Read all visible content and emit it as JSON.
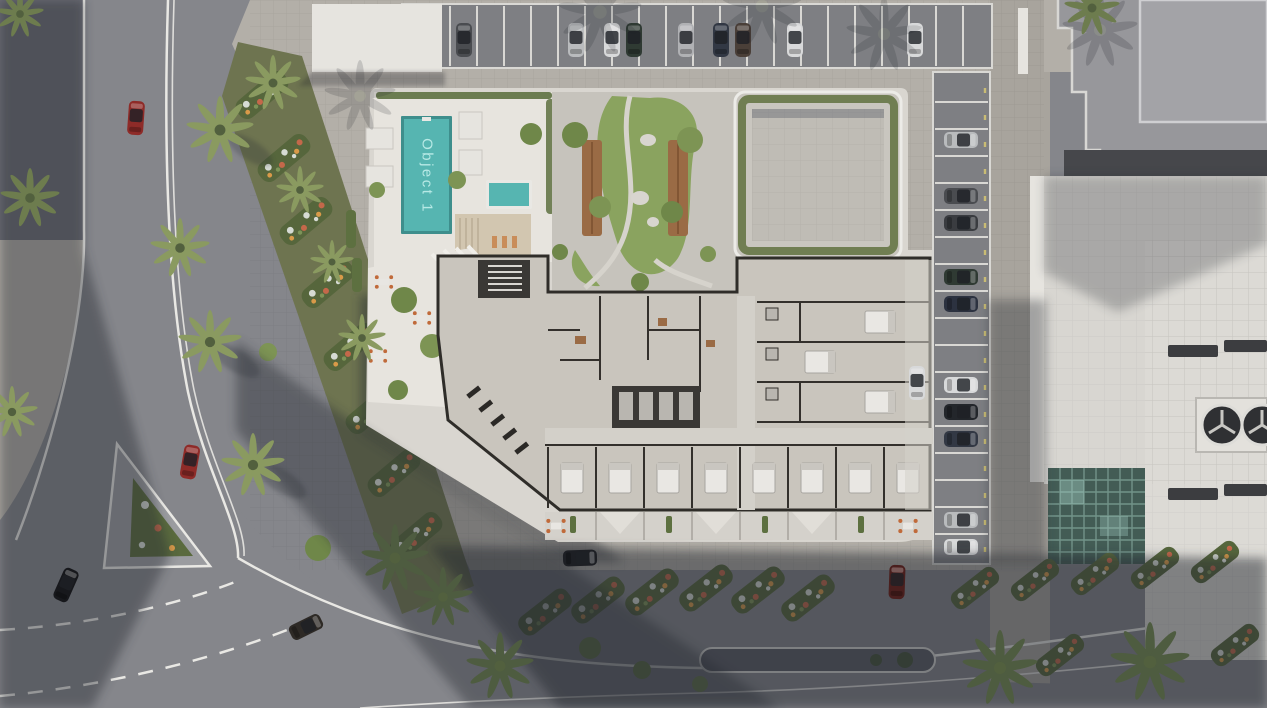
{
  "scene": {
    "description": "Aerial 3D architectural render of a residential complex: cutaway floor plan, rooftop pool deck, courtyard garden, roof terrace, parking rows with cars, surrounding streets with palm trees and flower beds, neighbouring building with rooftop fans",
    "labels": {
      "pool_object": "Object 1"
    },
    "colors": {
      "pool": "#56b5b1",
      "pool_edge": "#3e8e8c",
      "pool_label": "#b7e9e5",
      "lawn": "#8aa35f",
      "deck": "#e7e4de",
      "building_plate": "#d9d6d0",
      "floor": "#c9c5bd",
      "wall": "#33302c",
      "pavers": "#b3afa8",
      "asphalt": "#85868b",
      "shadow": "#262a33",
      "hedge": "#5d7040",
      "palm": "#8a9a60",
      "wood": "#9a6b45",
      "flower_red": "#c4684a",
      "flower_white": "#d6dbd4",
      "flower_yellow": "#d99a49",
      "roof_white": "#d8d6d1",
      "glass_atrium": "#435c55",
      "chair_orange": "#c06a3a",
      "road_line": "#e9e8e4"
    },
    "elements": {
      "main_pool": "swimming pool labeled Object 1",
      "kids_pool": "small secondary pool",
      "pool_deck": "white pool deck with cabanas and wooden sun deck",
      "courtyard_garden": "courtyard with lawn, winding paths, wooden planters, boulders and trees",
      "roof_terrace": "square roof terrace with hedge border",
      "floor_plan": "cutaway interior: apartments with beds, gym, lobby, stair and elevator cores",
      "balcony_strip": "ground terrace band with awnings, hedges and cafe tables",
      "top_parking": "perpendicular parking row with parked cars",
      "side_parking": "parking column with parked cars and yellow markers",
      "neighbor_building": "adjacent white building with stepped parapet, vents, rooftop fans, glass atrium",
      "streets": "roads with white markings, dashed lanes, triangular traffic island, median island",
      "landscaping": "palm trees, round shrubs and flower beds",
      "cars_driving": "red, black, brown and dark cars on the streets"
    }
  }
}
